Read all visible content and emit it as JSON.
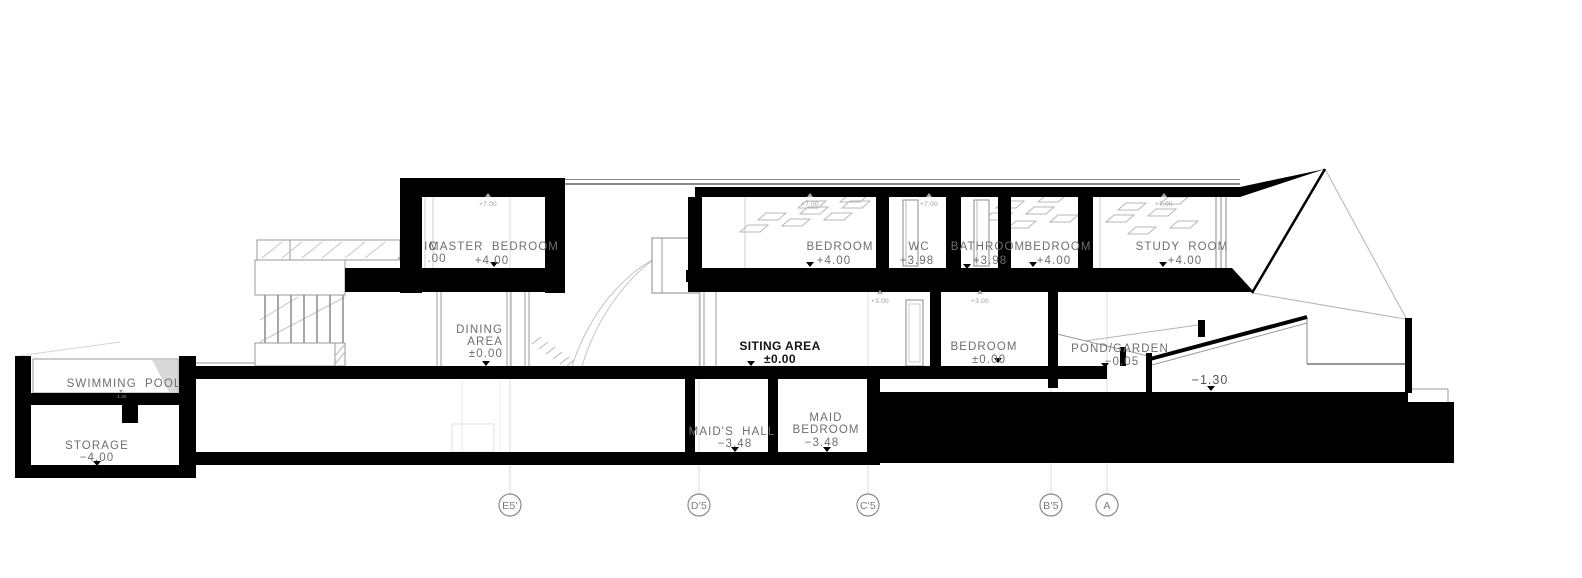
{
  "drawing": {
    "type": "architectural-building-section",
    "labels": {
      "swimming_pool": {
        "name": "SWIMMING POOL",
        "water_level": "-1.35"
      },
      "storage": {
        "name": "STORAGE",
        "level": "−4.00"
      },
      "hidden_room": {
        "frag_top": "IC",
        "frag_plus": "+",
        "frag_dec": ".00"
      },
      "master_bedroom": {
        "name": "MASTER BEDROOM",
        "level": "+4.00"
      },
      "bedroom_upper": {
        "name": "BEDROOM",
        "level": "+4.00"
      },
      "wc": {
        "name": "WC",
        "level": "+3.98"
      },
      "bathroom": {
        "name": "BATHROOM",
        "level": "+3.98"
      },
      "bedroom_upper_2": {
        "name": "BEDROOM",
        "level": "+4.00"
      },
      "study_room": {
        "name": "STUDY ROOM",
        "level": "+4.00"
      },
      "dining_area": {
        "line1": "DINING",
        "line2": "AREA",
        "level": "±0.00"
      },
      "siting_area": {
        "name": "SITING AREA",
        "level": "±0.00"
      },
      "bedroom_ground": {
        "name": "BEDROOM",
        "level": "±0.00"
      },
      "pond_garden": {
        "name": "POND/GARDEN",
        "level": "−0.05"
      },
      "terrace_level": "−1.30",
      "maids_hall": {
        "name": "MAID'S HALL",
        "level": "−3.48"
      },
      "maid_bedroom": {
        "line1": "MAID",
        "line2": "BEDROOM",
        "level": "−3.48"
      },
      "roof_level": "+7.00",
      "mid_level": "+3.00"
    },
    "grid_bubbles": [
      {
        "label": "E5'"
      },
      {
        "label": "D'5"
      },
      {
        "label": "C'5"
      },
      {
        "label": "B'5"
      },
      {
        "label": "A"
      }
    ],
    "colors": {
      "ink": "#000000",
      "label": "#6e6e6e",
      "label_dark": "#141414",
      "line": "#999999",
      "faint": "#cccccc",
      "water": "#d9d9d9"
    }
  }
}
